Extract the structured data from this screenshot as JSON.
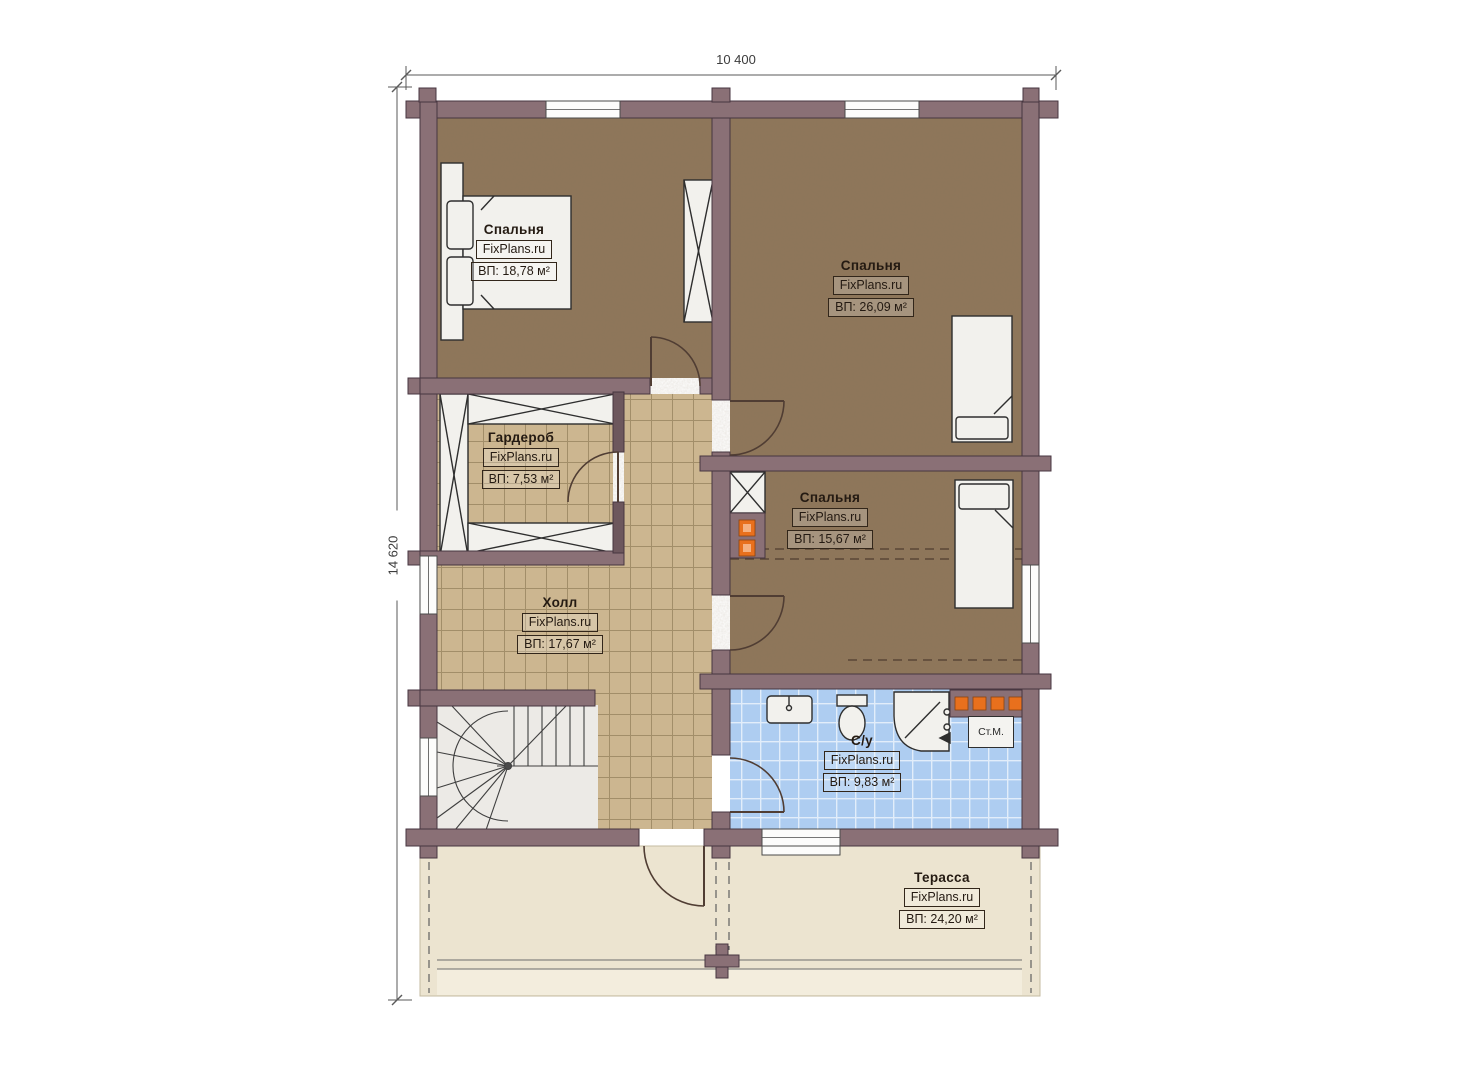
{
  "dimensions": {
    "width_label": "10 400",
    "height_label": "14 620"
  },
  "brand": "FixPlans.ru",
  "rooms": [
    {
      "id": "bedroom-1",
      "name": "Спальня",
      "area_label": "ВП: 18,78 м²"
    },
    {
      "id": "bedroom-2",
      "name": "Спальня",
      "area_label": "ВП: 26,09 м²"
    },
    {
      "id": "wardrobe",
      "name": "Гардероб",
      "area_label": "ВП: 7,53 м²"
    },
    {
      "id": "bedroom-3",
      "name": "Спальня",
      "area_label": "ВП: 15,67 м²"
    },
    {
      "id": "hall",
      "name": "Холл",
      "area_label": "ВП: 17,67 м²"
    },
    {
      "id": "bathroom",
      "name": "С/у",
      "area_label": "ВП: 9,83 м²"
    },
    {
      "id": "terrace",
      "name": "Терасса",
      "area_label": "ВП: 24,20 м²"
    }
  ],
  "appliances": {
    "washing_machine": "Ст.М."
  },
  "colors": {
    "wall": "#8a7076",
    "bedroom_floor": "#8e765a",
    "tile_tan": "#ccb690",
    "tile_blue": "#aecdf1",
    "terrace_floor": "#ece4d0",
    "accent_orange": "#e8701d"
  }
}
